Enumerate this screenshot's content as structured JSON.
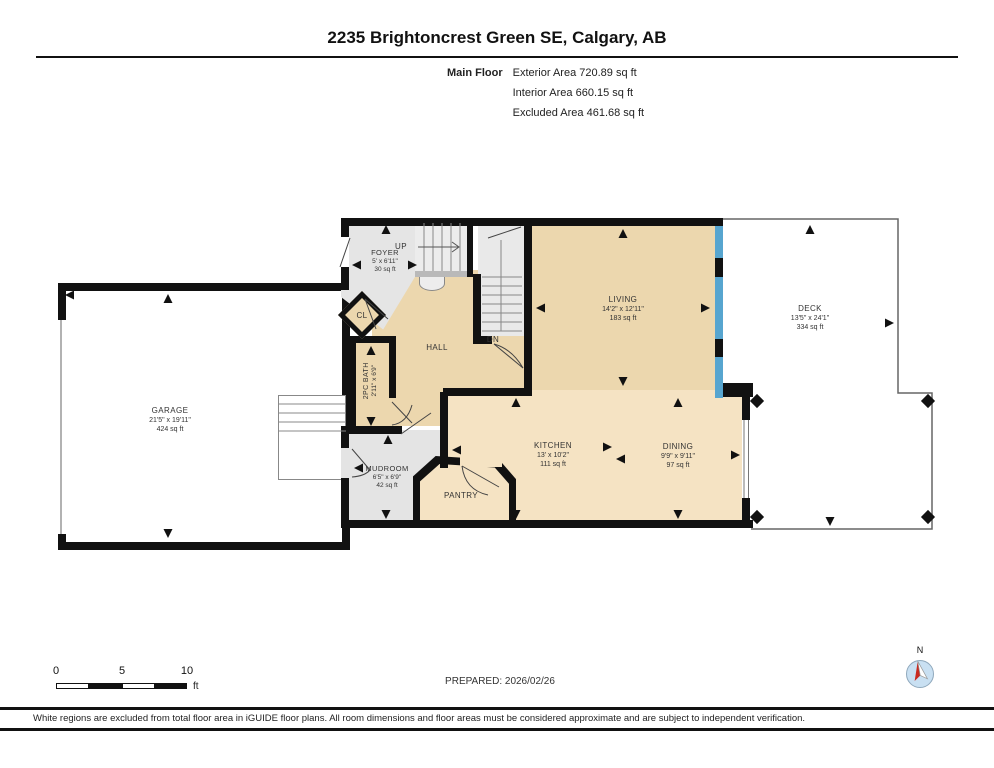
{
  "title": "2235 Brightoncrest Green SE, Calgary, AB",
  "header": {
    "floor_label": "Main Floor",
    "area_lines": [
      "Exterior Area 720.89 sq ft",
      "Interior Area 660.15 sq ft",
      "Excluded Area 461.68 sq ft"
    ]
  },
  "rooms": {
    "garage": {
      "name": "GARAGE",
      "dims": "21'5\" x 19'11\"",
      "area": "424 sq ft"
    },
    "foyer": {
      "name": "FOYER",
      "dims": "5' x 6'11\"",
      "area": "30 sq ft"
    },
    "closet": {
      "name": "CL"
    },
    "hall": {
      "name": "HALL"
    },
    "bath": {
      "name": "2PC BATH",
      "dims": "2'11\" x 6'9\""
    },
    "mudroom": {
      "name": "MUDROOM",
      "dims": "6'5\" x 6'9\"",
      "area": "42 sq ft"
    },
    "pantry": {
      "name": "PANTRY"
    },
    "kitchen": {
      "name": "KITCHEN",
      "dims": "13' x 10'2\"",
      "area": "111 sq ft"
    },
    "dining": {
      "name": "DINING",
      "dims": "9'9\" x 9'11\"",
      "area": "97 sq ft"
    },
    "living": {
      "name": "LIVING",
      "dims": "14'2\" x 12'11\"",
      "area": "183 sq ft"
    },
    "deck": {
      "name": "DECK",
      "dims": "13'5\" x 24'1\"",
      "area": "334 sq ft"
    }
  },
  "stairs": {
    "up_label": "UP",
    "down_label": "DN"
  },
  "scale_bar": {
    "tick0": "0",
    "tick5": "5",
    "tick10": "10",
    "unit": "ft"
  },
  "prepared": "PREPARED: 2026/02/26",
  "compass": {
    "north_label": "N"
  },
  "disclaimer": "White regions are excluded from total floor area in iGUIDE floor plans. All room dimensions and floor areas must be considered approximate and are subject to independent verification.",
  "colors": {
    "room_tan": "#ECD7AE",
    "room_tan_light": "#F5E3C3",
    "room_gray": "#E4E4E4",
    "wall_black": "#111111",
    "window_blue": "#57A5CF",
    "compass_blue": "#C9E0F2",
    "needle_red": "#C82A20"
  }
}
